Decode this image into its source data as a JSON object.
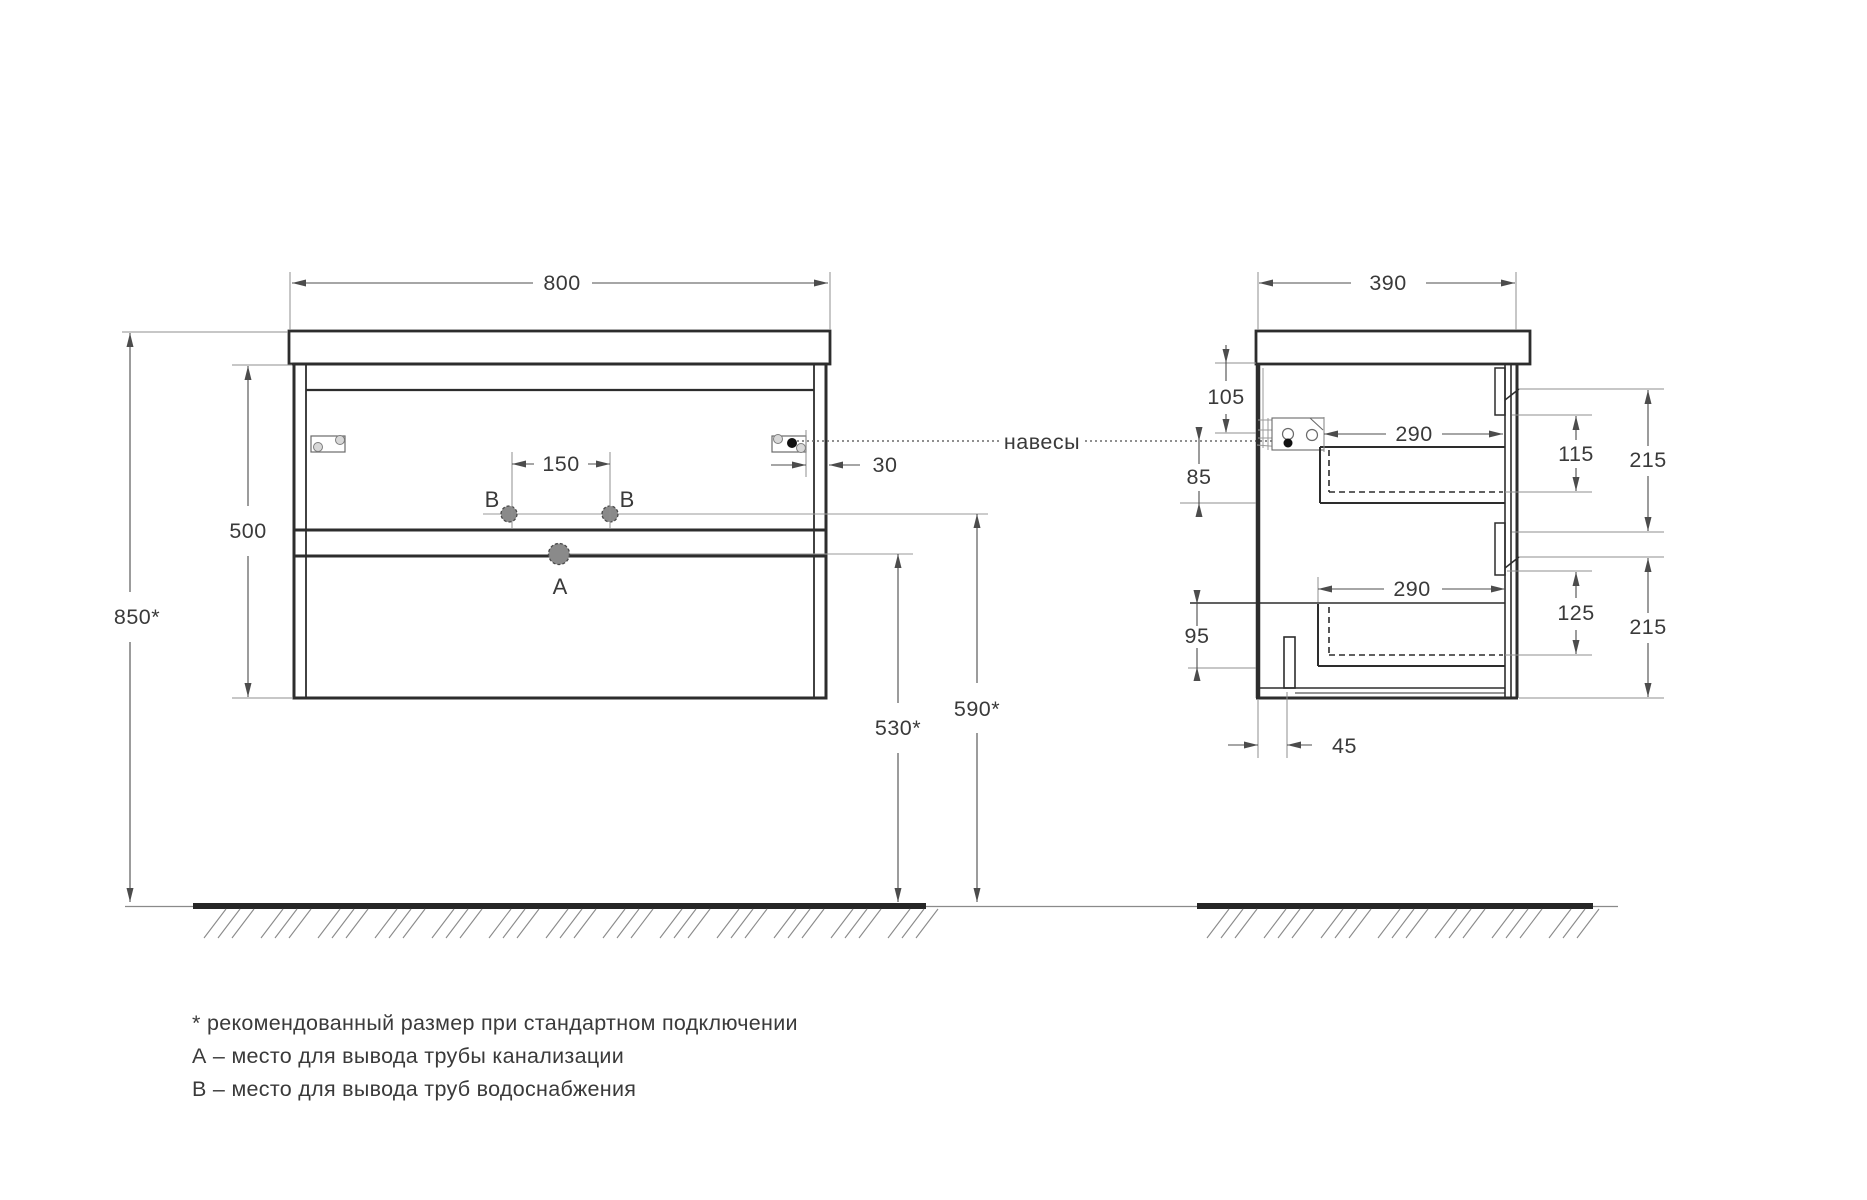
{
  "front_view": {
    "dims": {
      "width": "800",
      "height": "500",
      "install_height": "850*",
      "holes_gap": "150",
      "hanger_inset": "30",
      "drain_height": "530*",
      "supply_height": "590*"
    },
    "points": {
      "a": "A",
      "b_left": "B",
      "b_right": "B"
    }
  },
  "side_view": {
    "hangers_label": "навесы",
    "dims": {
      "depth": "390",
      "top_to_hangers": "105",
      "hangers_to_drawer": "85",
      "drawer1_depth": "290",
      "drawer1_inner_height": "115",
      "front1_height": "215",
      "drawer2_depth": "290",
      "drawer2_inner_height": "125",
      "front2_height": "215",
      "bottom_zone": "95",
      "bottom_inset": "45"
    }
  },
  "notes": {
    "line1": "* рекомендованный размер при стандартном подключении",
    "line2": "А – место для вывода трубы канализации",
    "line3": "В – место для вывода труб водоснабжения"
  },
  "colors": {
    "line": "#2d2d2d",
    "dimension": "#4c4c4c",
    "construction": "#8f8f8f",
    "text": "#3a3a3a",
    "point_fill": "#8a8a8a",
    "background": "#ffffff"
  }
}
